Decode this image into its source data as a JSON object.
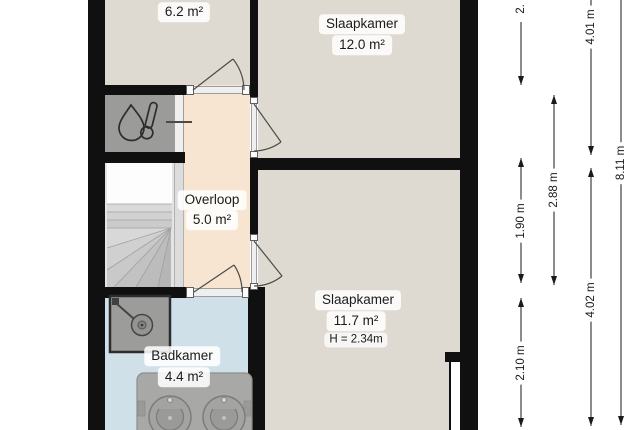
{
  "floorplan": {
    "rooms": {
      "room_top_left": {
        "area": "6.2 m²"
      },
      "bedroom_top": {
        "name": "Slaapkamer",
        "area": "12.0 m²"
      },
      "landing": {
        "name": "Overloop",
        "area": "5.0 m²"
      },
      "bedroom_right": {
        "name": "Slaapkamer",
        "area": "11.7 m²",
        "ceiling_height": "H = 2.34m"
      },
      "bathroom": {
        "name": "Badkamer",
        "area": "4.4 m²"
      }
    },
    "dimensions": {
      "top_partial": "2.",
      "stair_zone": "1.90 m",
      "bathroom_depth": "2.10 m",
      "left_zone": "2.88 m",
      "bedroom_top_depth": "4.01 m",
      "bedroom_right_depth": "4.02 m",
      "total_depth": "8.11 m"
    },
    "icons": {
      "boiler": "water-heater-icon",
      "shower": "shower-icon",
      "sinks": "double-washbasin-icon",
      "stairs": "staircase"
    },
    "colors": {
      "wall": "#101010",
      "floor_default": "#dedad2",
      "floor_landing": "#f7e5d1",
      "floor_bathroom": "#cfe0e8",
      "closet_fill": "#9b9b99",
      "background": "#ffffff",
      "dimension_line": "#1a1a1a"
    }
  }
}
